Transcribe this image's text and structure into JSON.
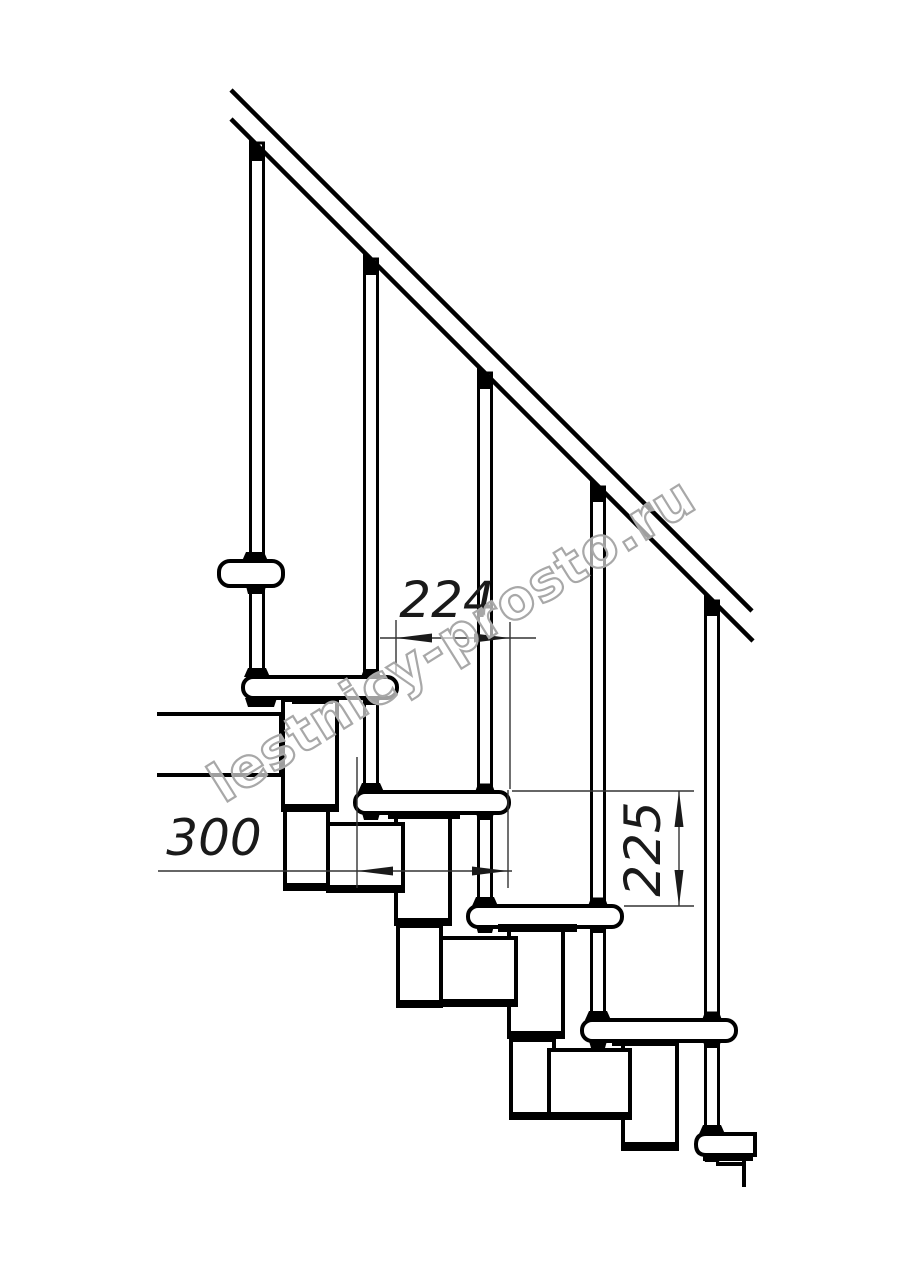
{
  "drawing": {
    "title": "modular-staircase-side-view",
    "watermark": "lestnicy-prosto.ru",
    "dimensions": {
      "going": {
        "label": "224"
      },
      "tread_depth": {
        "label": "300"
      },
      "riser": {
        "label": "225"
      }
    }
  }
}
